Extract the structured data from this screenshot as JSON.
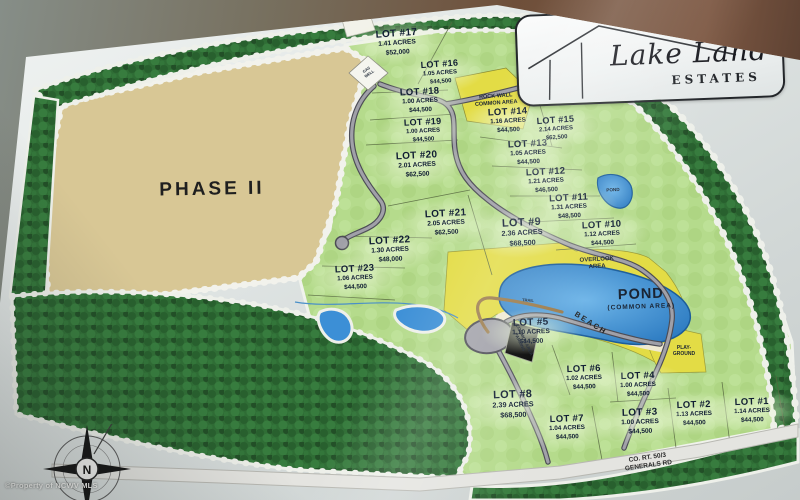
{
  "sign": {
    "logo_title": "Lake Land",
    "logo_subtitle": "ESTATES"
  },
  "map": {
    "phase_label": "PHASE II",
    "compass_letter": "N",
    "watermark": "©Property of NCWV MLS",
    "lots": [
      {
        "name": "LOT #1",
        "acres": "1.14 ACRES",
        "price": "$44,500"
      },
      {
        "name": "LOT #2",
        "acres": "1.13 ACRES",
        "price": "$44,500"
      },
      {
        "name": "LOT #3",
        "acres": "1.00 ACRES",
        "price": "$44,500"
      },
      {
        "name": "LOT #4",
        "acres": "1.00 ACRES",
        "price": "$44,500"
      },
      {
        "name": "LOT #5",
        "acres": "1.10 ACRES",
        "price": "$44,500"
      },
      {
        "name": "LOT #6",
        "acres": "1.02 ACRES",
        "price": "$44,500"
      },
      {
        "name": "LOT #7",
        "acres": "1.04 ACRES",
        "price": "$44,500"
      },
      {
        "name": "LOT #8",
        "acres": "2.39 ACRES",
        "price": "$68,500"
      },
      {
        "name": "LOT #9",
        "acres": "2.36 ACRES",
        "price": "$68,500"
      },
      {
        "name": "LOT #10",
        "acres": "1.12 ACRES",
        "price": "$44,500"
      },
      {
        "name": "LOT #11",
        "acres": "1.31 ACRES",
        "price": "$48,500"
      },
      {
        "name": "LOT #12",
        "acres": "1.21 ACRES",
        "price": "$46,500"
      },
      {
        "name": "LOT #13",
        "acres": "1.05 ACRES",
        "price": "$44,500"
      },
      {
        "name": "LOT #14",
        "acres": "1.16 ACRES",
        "price": "$44,500"
      },
      {
        "name": "LOT #15",
        "acres": "2.14 ACRES",
        "price": "$62,500"
      },
      {
        "name": "LOT #16",
        "acres": "1.05 ACRES",
        "price": "$44,500"
      },
      {
        "name": "LOT #17",
        "acres": "1.41 ACRES",
        "price": "$52,000"
      },
      {
        "name": "LOT #18",
        "acres": "1.00 ACRES",
        "price": "$44,500"
      },
      {
        "name": "LOT #19",
        "acres": "1.00 ACRES",
        "price": "$44,500"
      },
      {
        "name": "LOT #20",
        "acres": "2.01 ACRES",
        "price": "$62,500"
      },
      {
        "name": "LOT #21",
        "acres": "2.05 ACRES",
        "price": "$62,500"
      },
      {
        "name": "LOT #22",
        "acres": "1.30 ACRES",
        "price": "$48,000"
      },
      {
        "name": "LOT #23",
        "acres": "1.06 ACRES",
        "price": "$44,500"
      }
    ],
    "features": [
      {
        "id": "phase",
        "lines": [
          "PHASE II"
        ]
      },
      {
        "id": "rock-wall",
        "lines": [
          "ROCK WALL",
          "COMMON AREA"
        ]
      },
      {
        "id": "overlook",
        "lines": [
          "OVERLOOK",
          "AREA"
        ]
      },
      {
        "id": "pond-main",
        "lines": [
          "POND",
          "(COMMON AREA)"
        ]
      },
      {
        "id": "pond-small",
        "lines": [
          "POND"
        ]
      },
      {
        "id": "beach",
        "lines": [
          "BEACH"
        ]
      },
      {
        "id": "parking",
        "lines": [
          "COMMON AREA",
          "PARKING"
        ]
      },
      {
        "id": "playground",
        "lines": [
          "PLAY-",
          "GROUND"
        ]
      },
      {
        "id": "trail",
        "lines": [
          "TRAIL"
        ]
      },
      {
        "id": "gas-well",
        "lines": [
          "GAS",
          "WELL"
        ]
      },
      {
        "id": "road-name",
        "lines": [
          "CO. RT. 50/3",
          "GENERALS RD"
        ]
      },
      {
        "id": "float-price",
        "lines": [
          "$44,500"
        ]
      }
    ],
    "colors": {
      "forest": "#2f6d35",
      "lots_green": "#b5db8c",
      "phase_tan": "#d8c795",
      "common_yellow": "#e3dc45",
      "pond_blue": "#3c8fd6",
      "road_gray": "#a0a0a8"
    }
  }
}
